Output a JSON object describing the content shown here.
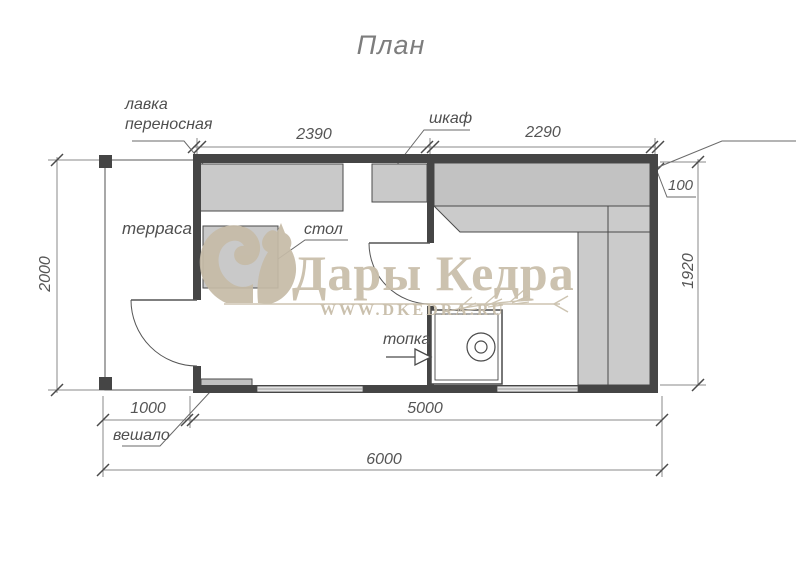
{
  "title": "План",
  "plan": {
    "annotations": {
      "portable_bench_line1": "лавка",
      "portable_bench_line2": "переносная",
      "cabinet": "шкаф",
      "terrace": "терраса",
      "table": "стол",
      "firebox": "топка",
      "hanger": "вешало"
    },
    "dimensions": {
      "room1_width": "2390",
      "room2_width": "2290",
      "wall_thickness": "100",
      "terrace_depth": "2000",
      "inner_depth": "1920",
      "terrace_width": "1000",
      "house_width": "5000",
      "total_width": "6000"
    }
  },
  "watermark": {
    "brand": "Дары Кедра",
    "site": "WWW.DKEDRA.RU"
  },
  "colors": {
    "wall": "#454545",
    "furniture": "#c9c9c9",
    "drawing_line": "#707070",
    "watermark": "#c9bfab"
  }
}
